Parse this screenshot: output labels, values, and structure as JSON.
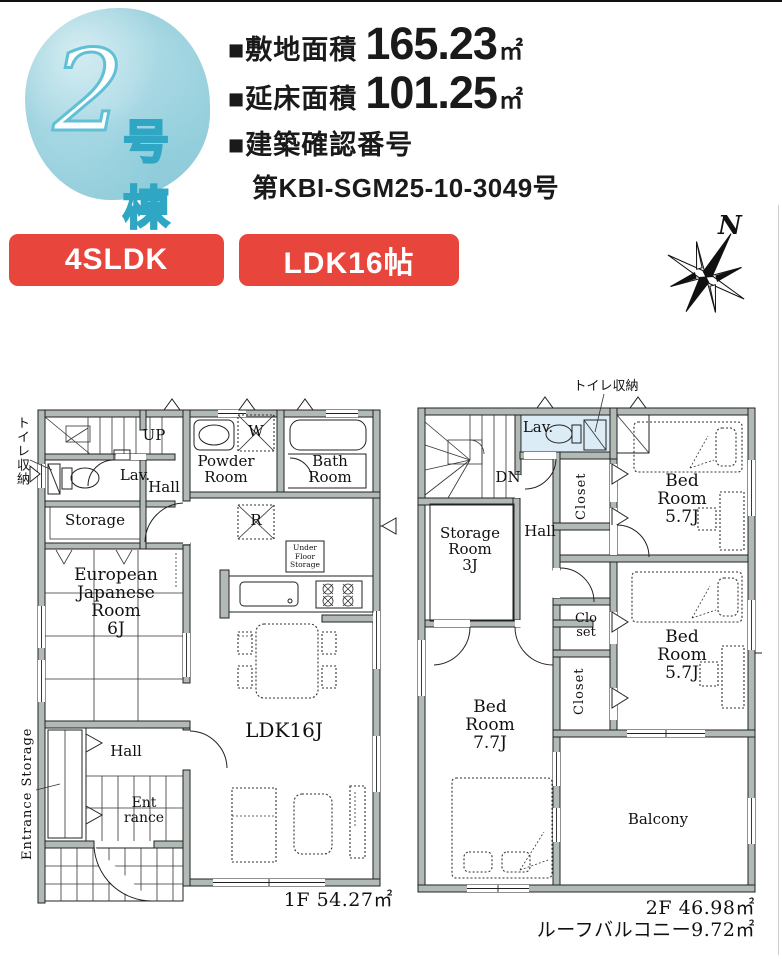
{
  "header": {
    "building_number": "2",
    "building_suffix": "号棟",
    "site_area_label": "■敷地面積",
    "site_area_value": "165.23",
    "site_area_unit": "㎡",
    "floor_area_label": "■延床面積",
    "floor_area_value": "101.25",
    "floor_area_unit": "㎡",
    "permit_label": "■建築確認番号",
    "permit_number": "第KBI-SGM25-10-3049号"
  },
  "badges": {
    "layout": "4SLDK",
    "ldk": "LDK16帖"
  },
  "compass": {
    "north": "N"
  },
  "floor1": {
    "toilet_storage": "トイレ収納",
    "up": "UP",
    "lav": "Lav.",
    "hall_upper": "Hall",
    "powder_room": [
      "Powder",
      "Room"
    ],
    "bath_room": [
      "Bath",
      "Room"
    ],
    "washer": "W",
    "fridge": "R",
    "storage": "Storage",
    "under_floor": [
      "Under",
      "Floor",
      "Storage"
    ],
    "european_japanese_room": [
      "European",
      "Japanese",
      "Room",
      "6J"
    ],
    "hall_lower": "Hall",
    "entrance": [
      "Ent",
      "rance"
    ],
    "entrance_storage": "Entrance Storage",
    "ldk": "LDK16J",
    "area": "1F 54.27㎡"
  },
  "floor2": {
    "toilet_storage": "トイレ収納",
    "dn": "DN",
    "lav": "Lav.",
    "closet_top": "Closet",
    "closet_mid": [
      "Clo",
      "set"
    ],
    "closet_low": "Closet",
    "hall": "Hall",
    "storage_room": [
      "Storage",
      "Room",
      "3J"
    ],
    "bedroom1": [
      "Bed",
      "Room",
      "5.7J"
    ],
    "bedroom2": [
      "Bed",
      "Room",
      "5.7J"
    ],
    "bedroom3": [
      "Bed",
      "Room",
      "7.7J"
    ],
    "balcony": "Balcony",
    "area": "2F 46.98㎡",
    "roof_balcony": "ルーフバルコニー9.72㎡"
  },
  "colors": {
    "badge_red": "#e8463d",
    "wall_gray": "#b2bab5",
    "circle_blue": "#a6d8e3",
    "lav_blue": "#dcecf6",
    "outline_teal": "#2fa6c3"
  }
}
